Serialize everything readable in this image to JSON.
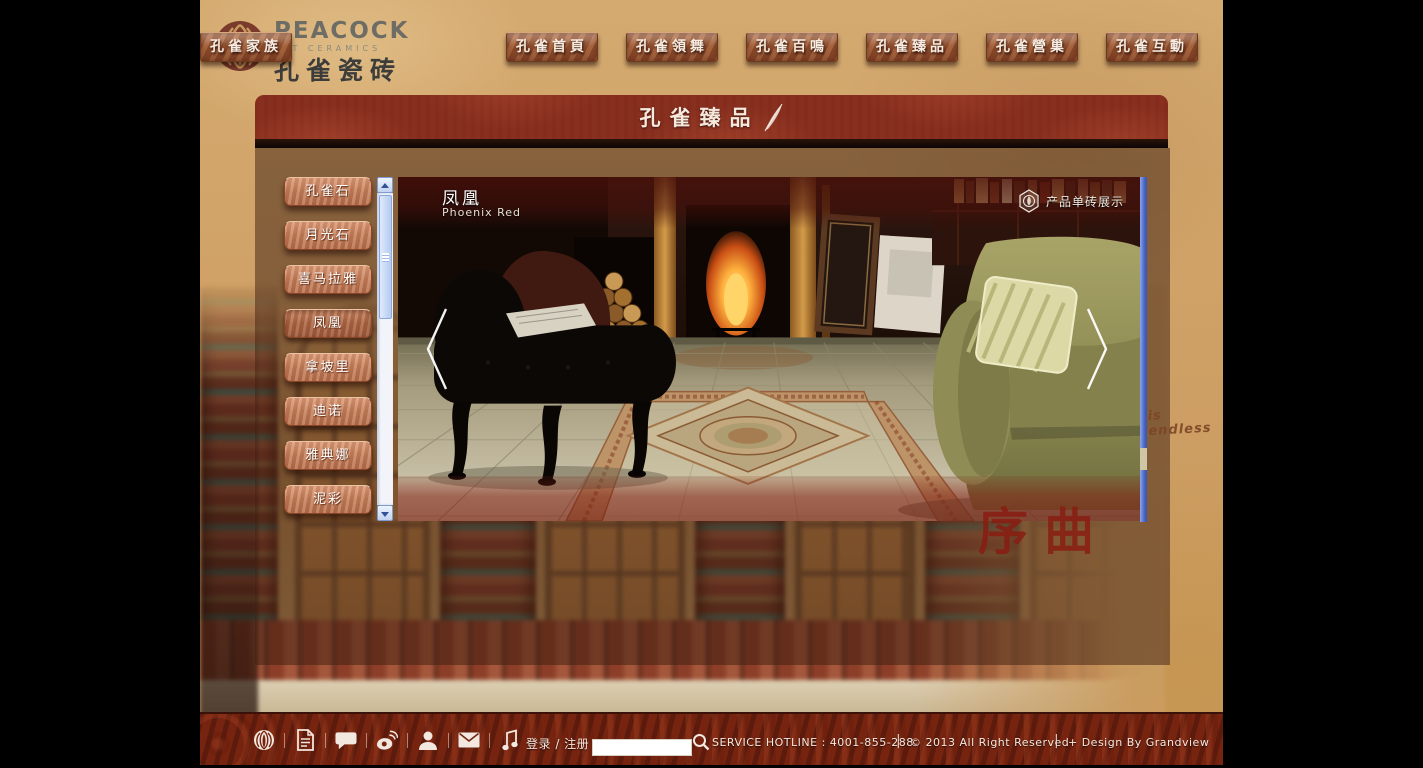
{
  "header": {
    "brand": "PEACOCK",
    "brand_sub": "ART CERAMICS",
    "brand_cn": "孔雀瓷砖",
    "nav": [
      {
        "label": "孔雀首頁"
      },
      {
        "label": "孔雀領舞"
      },
      {
        "label": "孔雀百鳴"
      },
      {
        "label": "孔雀臻品"
      },
      {
        "label": "孔雀營巢"
      },
      {
        "label": "孔雀互動"
      },
      {
        "label": "孔雀家族"
      }
    ]
  },
  "banner": {
    "title": "孔雀臻品"
  },
  "sidebar": {
    "items": [
      {
        "label": "孔雀石"
      },
      {
        "label": "月光石"
      },
      {
        "label": "喜马拉雅"
      },
      {
        "label": "凤凰"
      },
      {
        "label": "拿坡里"
      },
      {
        "label": "迪诺"
      },
      {
        "label": "雅典娜"
      },
      {
        "label": "泥彩"
      }
    ]
  },
  "product": {
    "name_cn": "凤凰",
    "name_en": "Phoenix Red",
    "badge": "产品单砖展示"
  },
  "decor": {
    "script_note": "is endless",
    "calligraphy": "序曲"
  },
  "footer": {
    "icons": [
      "peacock-logo-icon",
      "document-icon",
      "chat-icon",
      "weibo-icon",
      "user-icon",
      "mail-icon",
      "music-icon"
    ],
    "login": "登录 / 注册",
    "search_value": "",
    "hotline": "SERVICE HOTLINE : 4001-855-288",
    "copyright": "© 2013 All Right Reserved",
    "credit": "+ Design By Grandview",
    "divider": "|"
  },
  "colors": {
    "banner_red": "#7c2a1c",
    "footer_red": "#76240f",
    "parchment": "#cfa065",
    "nav_brick": "#97532f",
    "sidebar_copper": "#bf7b58",
    "image_scrollbar_blue": "#4a66c8",
    "calligraphy_red": "#8a1a10"
  }
}
